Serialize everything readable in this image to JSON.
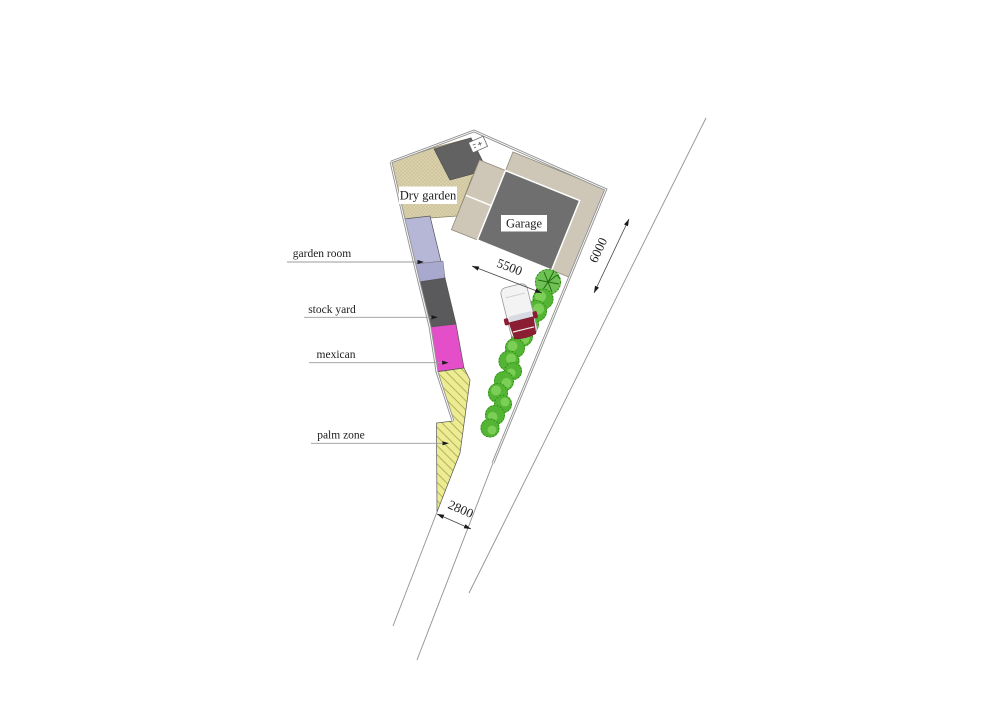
{
  "plan": {
    "area_labels": {
      "dry_garden": "Dry garden",
      "garage": "Garage"
    },
    "zone_labels": {
      "garden_room": "garden room",
      "stock_yard": "stock yard",
      "mexican": "mexican",
      "palm_zone": "palm zone"
    },
    "dimensions": {
      "d5500": "5500",
      "d6000": "6000",
      "d2800": "2800"
    },
    "colors": {
      "dry_garden_beige": "#dcd3b0",
      "garage_gray": "#6f6f6f",
      "paving_taupe": "#cec7b7",
      "garden_room_lavender": "#b6b6d7",
      "stock_yard_gray": "#5a5a5c",
      "mexican_magenta": "#e44fc9",
      "palm_yellow": "#edec92",
      "shrub_green": "#54b433",
      "car_red": "#8c1e33",
      "boundary_gray": "#949494"
    }
  }
}
